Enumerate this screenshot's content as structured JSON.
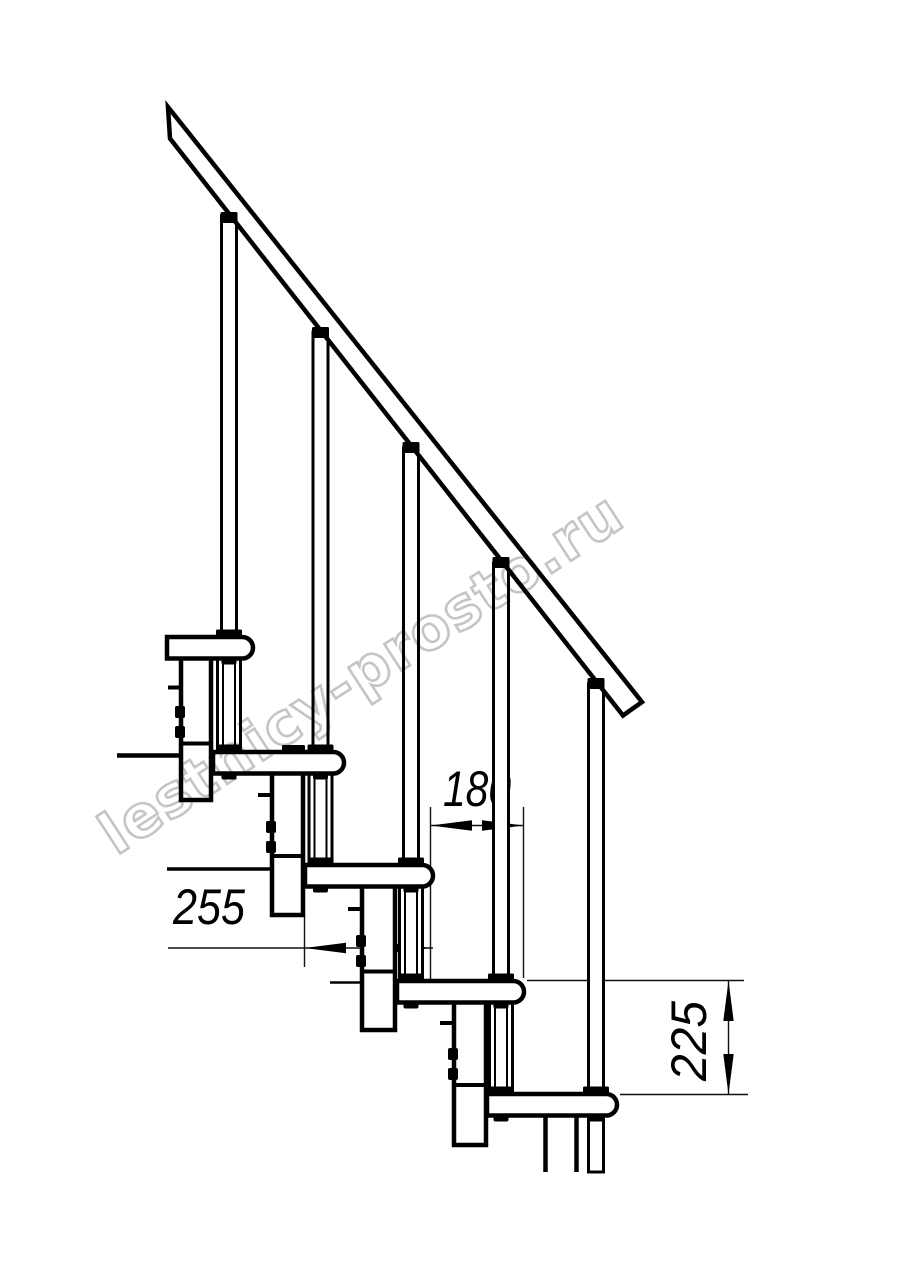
{
  "page": {
    "background": "#ffffff",
    "line_color": "#000000"
  },
  "drawing": {
    "watermark": {
      "text": "lestnicy-prosto.ru",
      "color": "#c5c5c5"
    },
    "dimensions": {
      "going": "180",
      "tread_depth": "255",
      "rise": "225"
    }
  }
}
